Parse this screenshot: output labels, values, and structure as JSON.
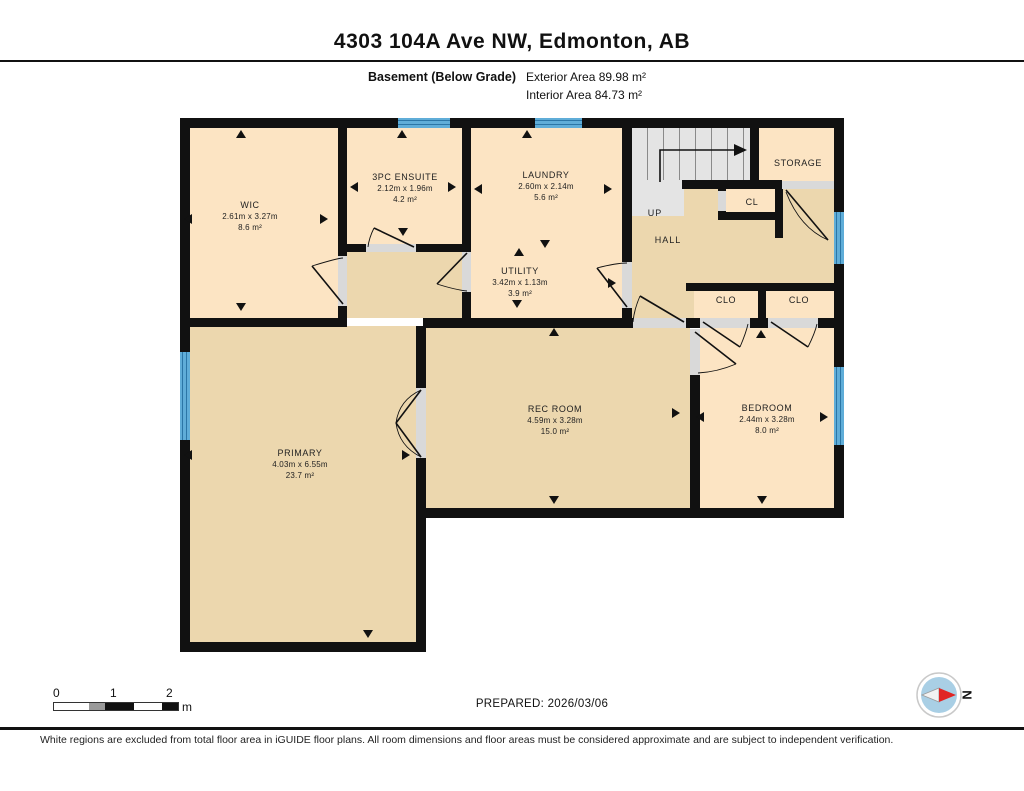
{
  "header": {
    "title": "4303 104A Ave NW, Edmonton, AB",
    "floor_label": "Basement (Below Grade)",
    "exterior_area": "Exterior Area 89.98 m²",
    "interior_area": "Interior Area 84.73 m²"
  },
  "rooms": {
    "wic": {
      "name": "WIC",
      "dims": "2.61m x 3.27m",
      "area": "8.6 m²"
    },
    "ensuite": {
      "name": "3PC ENSUITE",
      "dims": "2.12m x 1.96m",
      "area": "4.2 m²"
    },
    "laundry": {
      "name": "LAUNDRY",
      "dims": "2.60m x 2.14m",
      "area": "5.6 m²"
    },
    "utility": {
      "name": "UTILITY",
      "dims": "3.42m x 1.13m",
      "area": "3.9 m²"
    },
    "storage": {
      "name": "STORAGE"
    },
    "up": {
      "name": "UP"
    },
    "hall": {
      "name": "HALL"
    },
    "cl": {
      "name": "CL"
    },
    "clo_left": {
      "name": "CLO"
    },
    "clo_right": {
      "name": "CLO"
    },
    "rec": {
      "name": "REC ROOM",
      "dims": "4.59m x 3.28m",
      "area": "15.0 m²"
    },
    "bedroom": {
      "name": "BEDROOM",
      "dims": "2.44m x 3.28m",
      "area": "8.0 m²"
    },
    "primary": {
      "name": "PRIMARY",
      "dims": "4.03m x 6.55m",
      "area": "23.7 m²"
    }
  },
  "footer": {
    "scale_ticks": [
      "0",
      "1",
      "2"
    ],
    "scale_unit": "m",
    "prepared": "PREPARED: 2026/03/06",
    "compass_letter": "N",
    "disclaimer": "White regions are excluded from total floor area in iGUIDE floor plans. All room dimensions and floor areas must be considered approximate and are subject to independent verification."
  },
  "colors": {
    "room_light": "#fce4c3",
    "room_tan": "#ecd7ae",
    "wall": "#111111",
    "window_blue": "#5fadd8",
    "stairs_gray": "#e4e4e4",
    "compass_needle": "#e02525"
  }
}
